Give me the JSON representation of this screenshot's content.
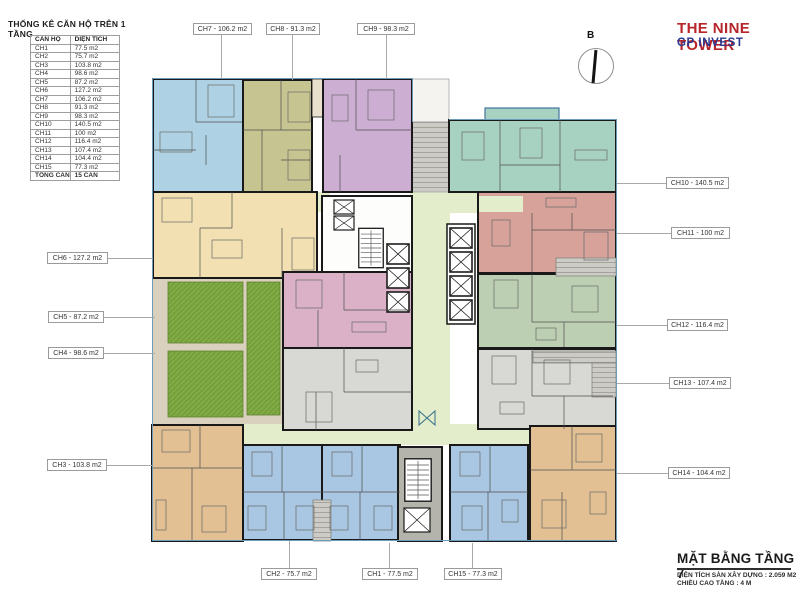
{
  "brand": {
    "title": "THE NINE TOWER",
    "subtitle": "GP INVEST",
    "title_color": "#b6252b",
    "subtitle_color": "#2b3990"
  },
  "stats_table": {
    "title": "THỐNG KÊ CĂN HỘ TRÊN 1 TẦNG",
    "columns": [
      "CĂN HỘ",
      "DIỆN TÍCH"
    ],
    "rows": [
      [
        "CH1",
        "77.5 m2"
      ],
      [
        "CH2",
        "75.7 m2"
      ],
      [
        "CH3",
        "103.8 m2"
      ],
      [
        "CH4",
        "98.6 m2"
      ],
      [
        "CH5",
        "87.2 m2"
      ],
      [
        "CH6",
        "127.2 m2"
      ],
      [
        "CH7",
        "106.2 m2"
      ],
      [
        "CH8",
        "91.3 m2"
      ],
      [
        "CH9",
        "98.3 m2"
      ],
      [
        "CH10",
        "140.5 m2"
      ],
      [
        "CH11",
        "100 m2"
      ],
      [
        "CH12",
        "116.4 m2"
      ],
      [
        "CH13",
        "107.4 m2"
      ],
      [
        "CH14",
        "104.4 m2"
      ],
      [
        "CH15",
        "77.3 m2"
      ]
    ],
    "total_row": [
      "TỔNG CĂN",
      "15 CĂN"
    ]
  },
  "labels": {
    "top": [
      "CH7 - 106.2 m2",
      "CH8 - 91.3 m2",
      "CH9 - 98.3 m2"
    ],
    "left": [
      "CH6 - 127.2 m2",
      "CH5 - 87.2 m2",
      "CH4 - 98.6 m2",
      "CH3 - 103.8 m2"
    ],
    "right": [
      "CH10 - 140.5 m2",
      "CH11 - 100 m2",
      "CH12 - 116.4 m2",
      "CH13 - 107.4 m2",
      "CH14 - 104.4 m2"
    ],
    "bottom": [
      "CH2 - 75.7 m2",
      "CH1 - 77.5 m2",
      "CH15 - 77.3 m2"
    ]
  },
  "compass": {
    "letter": "B"
  },
  "footer": {
    "title": "MẶT BẰNG TẦNG 7",
    "spec1": "DIỆN TÍCH SÀN XÂY DỰNG :  2.059 M2",
    "spec2": "CHIỀU CAO TẦNG : 4 M"
  },
  "palette": {
    "ch1": "#a9c6e2",
    "ch2": "#a9c6e2",
    "ch15": "#a9c6e2",
    "ch3": "#e2c094",
    "ch14": "#e2c094",
    "ch4": "#d8d8d5",
    "ch13": "#d8d8d5",
    "ch5": "#dab1c6",
    "ch6": "#f2e0b2",
    "ch7": "#aed2e3",
    "ch8": "#c6c491",
    "ch9": "#ccaed3",
    "ch10": "#a7d2c2",
    "ch11": "#d6a29a",
    "ch12": "#bccfb2",
    "corridor": "#e3edcc",
    "garden": "#76a03c",
    "path": "#d9d1bd",
    "core_gray": "#b4b4ac"
  }
}
